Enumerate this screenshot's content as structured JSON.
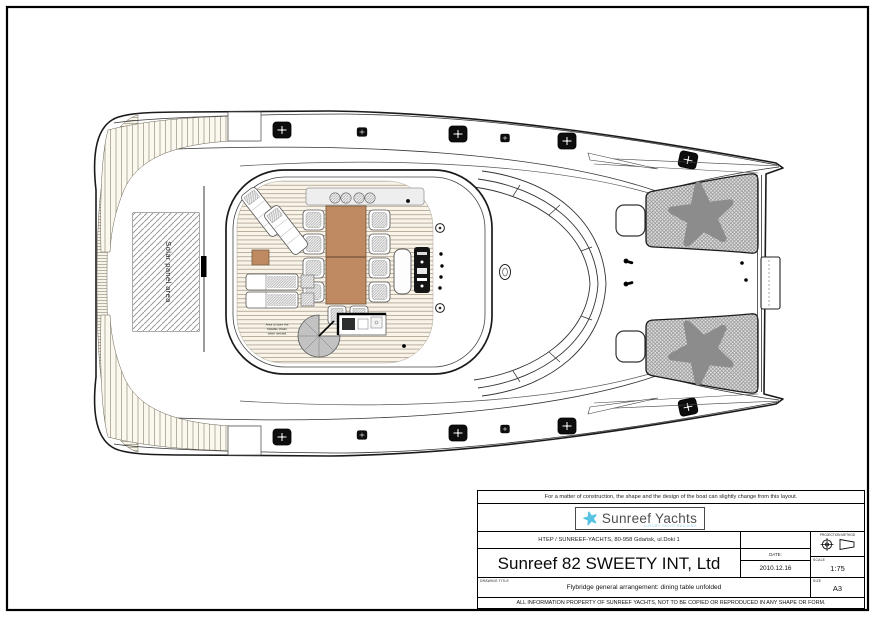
{
  "drawing": {
    "solar_panel_label": "Solar panel area",
    "storage_note_lines": {
      "l1": "Area to store the",
      "l2": "foldable chairs",
      "l3": "when needed"
    },
    "colors": {
      "table_brown": "#bf8a61",
      "starfish": "#8c8c8c"
    }
  },
  "title_block": {
    "disclaimer": "For a matter of construction, the shape and the design of the boat can slightly change from this layout.",
    "logo": {
      "name": "Sunreef Yachts",
      "tagline": "LUXURY YACHT BUILDING",
      "star_color": "#56c3e3"
    },
    "address": "HTEP / SUNREEF-YACHTS, 80-958 Gdańsk, ul.Doki 1",
    "project_title": "Sunreef 82 SWEETY INT, Ltd",
    "projection_label": "PROJECTION METHOD",
    "date_label": "DATE:",
    "date_value": "2010.12.16",
    "scale_label": "SCALE",
    "scale_value": "1:75",
    "size_label": "SIZE",
    "size_value": "A3",
    "drawing_title_label": "DRAWING TITLE",
    "drawing_title": "Flybridge general arrangement: dining table unfolded",
    "footer": "ALL INFORMATION PROPERTY OF SUNREEF YACHTS, NOT TO BE COPIED OR REPRODUCED IN ANY SHAPE OR FORM."
  }
}
